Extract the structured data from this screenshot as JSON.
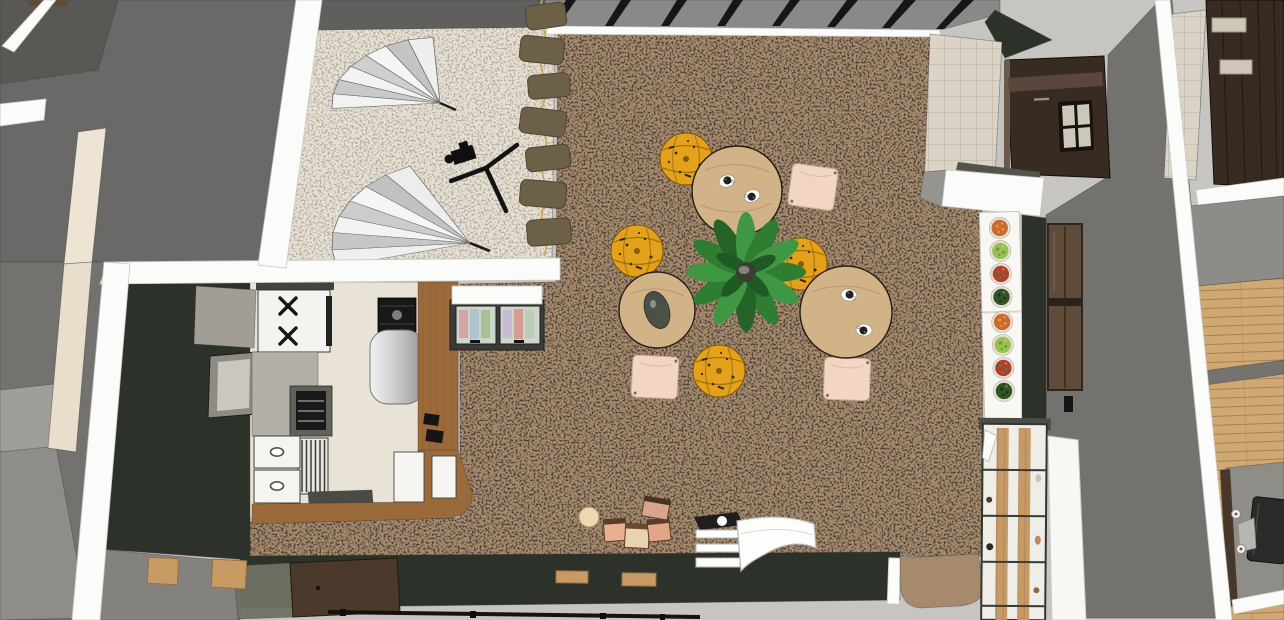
{
  "scene": {
    "title": "Top-down 3D render of a cafe interior with photo studio corner, kitchen, lounge seating, salad bar and adjacent rooms",
    "render_style": "sketchup-3d-cutaway-plan-view",
    "rooms": {
      "photo_studio": {
        "label": "photo studio corner",
        "props": [
          "two silver light umbrellas",
          "camera on tripod",
          "cream speckled floor"
        ]
      },
      "kitchen": {
        "label": "kitchen",
        "props": [
          "gas stove with 2 visible burners",
          "range hood",
          "oven",
          "dish rack",
          "2 white drawers with oval handles",
          "silver rounded fridge",
          "espresso machine",
          "L-shaped wood counter",
          "pastry display case with 2 glass doors",
          "window"
        ]
      },
      "cafe_lounge": {
        "label": "lounge dining area",
        "props": [
          "3 round wood tables",
          "4 coffee cups",
          "1 serving tray",
          "4 yellow patterned floor poufs",
          "3 pink square floor cushions",
          "1 large center plant",
          "kids blocks corner",
          "white curved bench"
        ]
      },
      "salad_bar": {
        "label": "salad bar counter",
        "props": [
          "8 salad plates in two groups of four",
          "white service counter",
          "brown glass door panels"
        ]
      },
      "entry": {
        "label": "entry / front wall",
        "props": [
          "dark green front wall",
          "wood entry door",
          "carpet tongue through doorway",
          "cube storage shelf"
        ]
      },
      "adjacent_room": {
        "label": "adjacent office room",
        "props": [
          "wood plank floor",
          "desk with monitor",
          "dark wood wall panel",
          "tiled column"
        ]
      }
    },
    "objects": {
      "umbrellas": 2,
      "tripods": 1,
      "hanging_garland": 1,
      "round_tables": 3,
      "coffee_cups": 4,
      "serving_trays": 1,
      "floor_poufs": 4,
      "pink_cushions": 3,
      "center_plants": 1,
      "salad_plates": 8,
      "display_case_doors": 2,
      "stove_burners_visible": 2,
      "kitchen_drawers": 2,
      "kids_blocks": 4,
      "kids_round_pouf": 1,
      "curved_benches": 1,
      "cube_shelves": 1,
      "entry_doors": 1,
      "monitors": 1,
      "window_panes": 4
    },
    "palette": {
      "bg_light": "#c6c5c2",
      "wall_gray_mid": "#74726f",
      "wall_gray_dark": "#6b6967",
      "wall_white": "#fbfbf9",
      "studio_floor": "#e8e1d3",
      "carpet": "#a58a6e",
      "carpet_line": "#7e6750",
      "kitchen_floor": "#e9e3d7",
      "dark_green_wall": "#2c312a",
      "wood_counter": "#9b6a3a",
      "wood_light": "#c59a67",
      "table_wood": "#d2b287",
      "pouf_yellow": "#e3a11c",
      "cushion_pink": "#f3d5c4",
      "plant_green": "#2e7d32",
      "plant_green_light": "#3f9643",
      "fridge_silver": "#cfcfcf",
      "oven_black": "#191919",
      "brown_cabinet": "#382b21",
      "tile_beige": "#dbd4c6",
      "glass_gray": "#8b8987",
      "mullion_black": "#161616",
      "garland_olive": "#6c6047",
      "gold": "#c9a553",
      "salad_orange": "#c96a2e",
      "salad_green": "#9abf55",
      "salad_mixed": "#b0402c",
      "salad_dark": "#2f5526",
      "plank_wood": "#cfa873"
    }
  }
}
